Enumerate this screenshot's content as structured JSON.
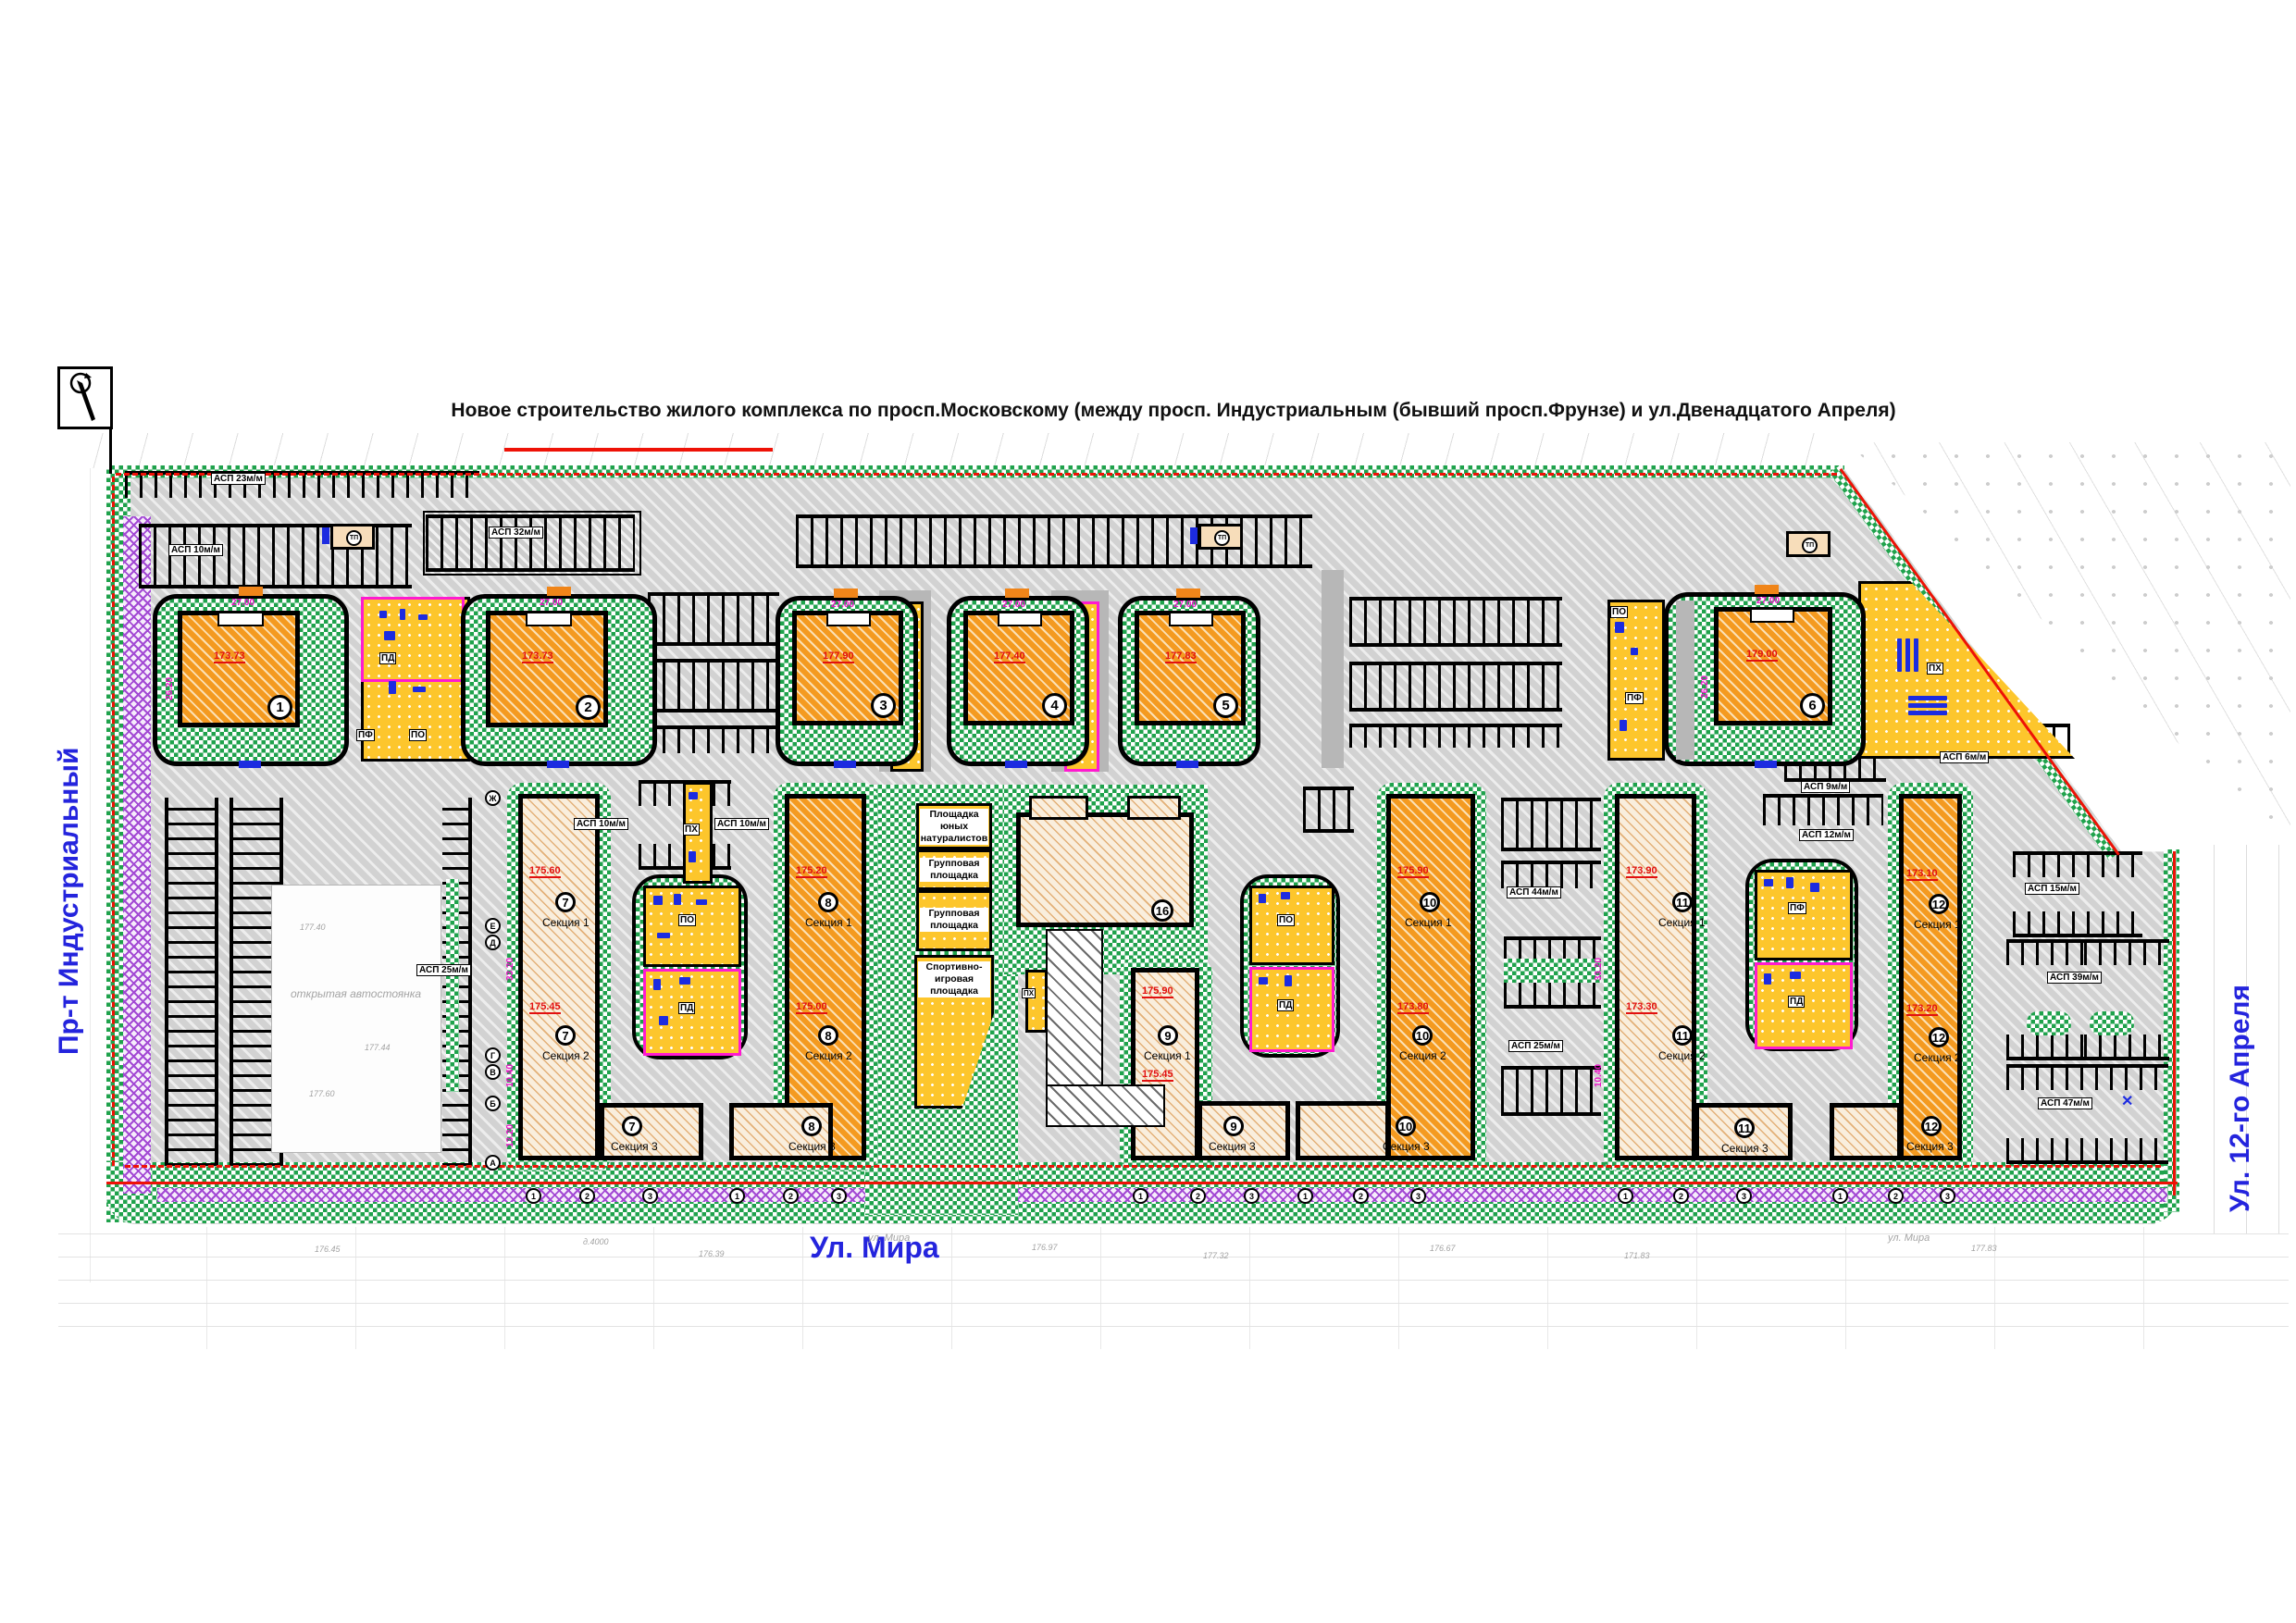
{
  "title": "Новое строительство жилого комплекса по просп.Московскому (между просп. Индустриальным (бывший просп.Фрунзе)   и ул.Двенадцатого Апреля)",
  "streets": {
    "left": "Пр-т Индустриальный",
    "bottom": "Ул. Мира",
    "right": "Ул. 12-го Апреля",
    "survey_bottom": "ул. Мира"
  },
  "towers": [
    {
      "num": "1",
      "elev": "173.73"
    },
    {
      "num": "2",
      "elev": "173.73"
    },
    {
      "num": "3",
      "elev": "177.90"
    },
    {
      "num": "4",
      "elev": "177.40"
    },
    {
      "num": "5",
      "elev": "177.83"
    },
    {
      "num": "6",
      "elev": "179.00"
    }
  ],
  "blocks": [
    {
      "num": "7",
      "sections": [
        "Секция 1",
        "Секция 2",
        "Секция 3"
      ],
      "elev_top": "175.60",
      "elev_mid": "175.45"
    },
    {
      "num": "8",
      "sections": [
        "Секция 1",
        "Секция 2",
        "Секция 3"
      ],
      "elev_top": "175.20",
      "elev_mid": "175.00"
    },
    {
      "num": "9",
      "sections": [
        "Секция 1",
        "Секция 3"
      ],
      "elev_top": "175.90",
      "elev_mid": "175.45"
    },
    {
      "num": "10",
      "sections": [
        "Секция 1",
        "Секция 2",
        "Секция 3"
      ],
      "elev_top": "175.90",
      "elev_mid": "173.80"
    },
    {
      "num": "11",
      "sections": [
        "Секция 1",
        "Секция 2",
        "Секция 3"
      ],
      "elev_top": "173.90",
      "elev_mid": "173.30"
    },
    {
      "num": "12",
      "sections": [
        "Секция 1",
        "Секция 2",
        "Секция 3"
      ],
      "elev_top": "173.10",
      "elev_mid": "173.20"
    }
  ],
  "center_building": {
    "num": "16"
  },
  "pg": {
    "pd": "ПД",
    "po": "ПО",
    "pf": "ПФ",
    "ph": "ПХ"
  },
  "areas": {
    "naturalists": "Площадка юных натуралистов",
    "group1": "Групповая площадка",
    "group2": "Групповая площадка",
    "sport": "Спортивно-игровая площадка",
    "open_parking": "открытая автостоянка"
  },
  "parking": {
    "p23": "АСП 23м/м",
    "p10": "АСП 10м/м",
    "p32": "АСП 32м/м",
    "p25": "АСП 25м/м",
    "p25b": "АСП 25м/м",
    "p44": "АСП 44м/м",
    "p12": "АСП 12м/м",
    "p9": "АСП 9м/м",
    "p6": "АСП 6м/м",
    "p15": "АСП 15м/м",
    "p39": "АСП 39м/м",
    "p47": "АСП 47м/м",
    "p10b": "АСП 10м/м",
    "p10c": "АСП 10м/м"
  },
  "dims": {
    "d27": "27.00",
    "d26": "26.20",
    "d33": "33.20",
    "d104": "10.40",
    "d132": "13.20"
  },
  "axis": {
    "letters": [
      "Ж",
      "Е",
      "Д",
      "Г",
      "В",
      "Б",
      "А"
    ],
    "nums": [
      "1",
      "2",
      "3"
    ]
  },
  "tp": "ТП",
  "marks": {
    "cross": "✕"
  },
  "survey_notes": [
    "176.45",
    "д.4000",
    "176.39",
    "176.97",
    "177.32",
    "176.67",
    "171.83",
    "177.83",
    "177.40",
    "177.44",
    "177.60"
  ],
  "colors": {
    "green": "#1fa24c",
    "yellow": "#fdc62c",
    "orange": "#f49a20",
    "tan": "#f9eedd",
    "magenta_border": "#ff1ad0",
    "red_line": "#ee1207",
    "street_blue": "#2424dd",
    "equipment_blue": "#1c2be0",
    "purple": "#a34ad4"
  }
}
